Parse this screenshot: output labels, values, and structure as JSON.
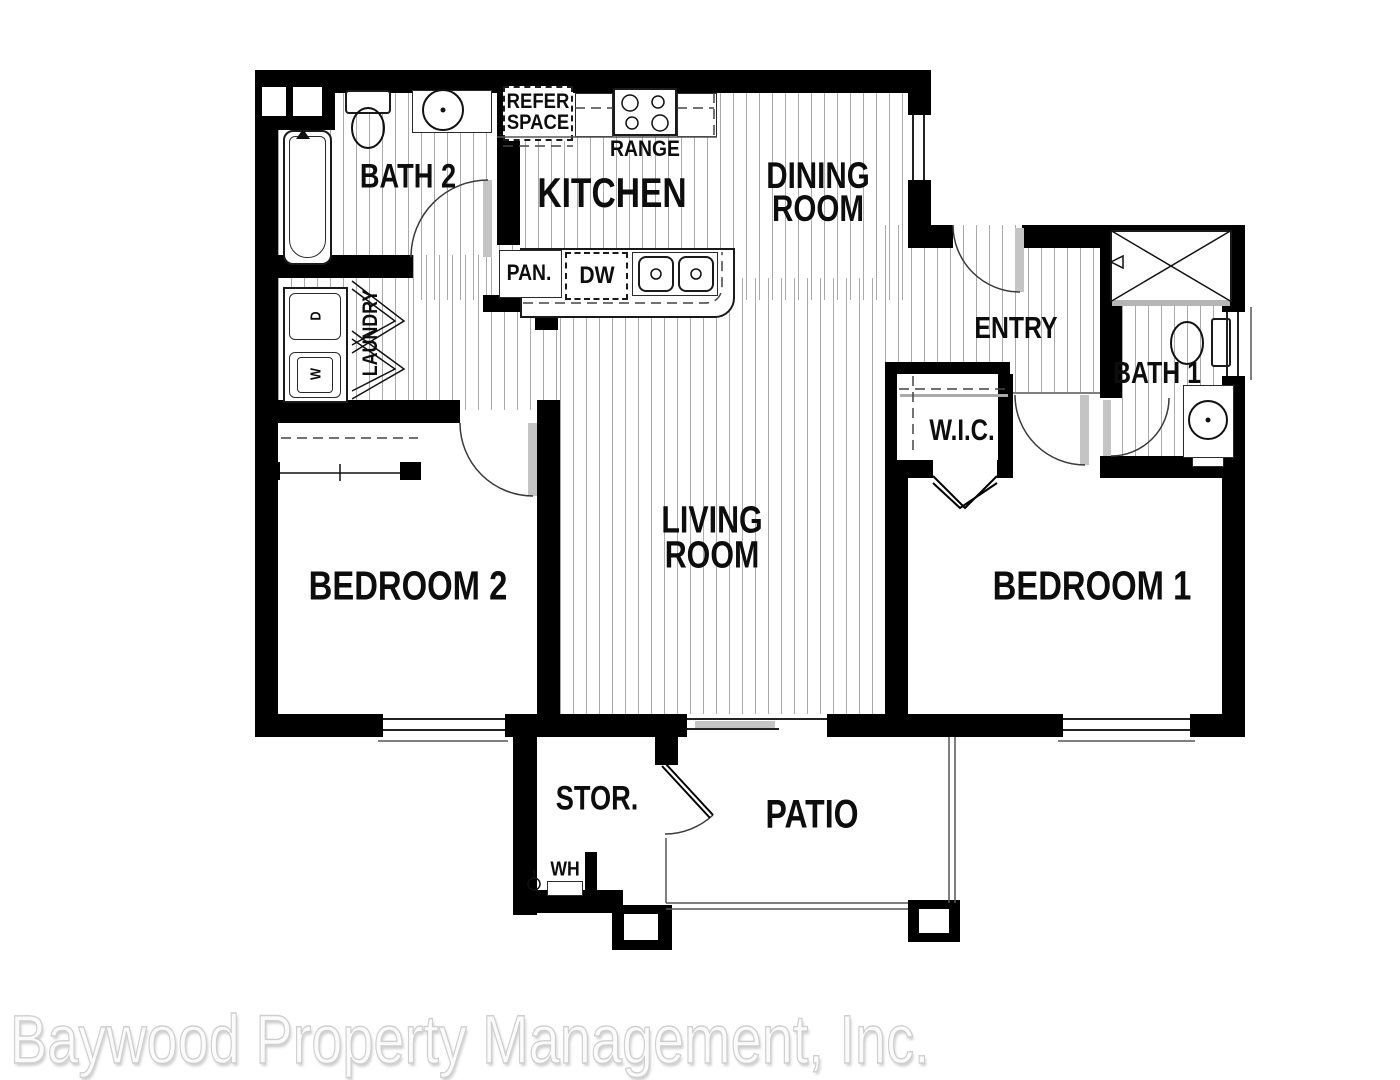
{
  "rooms": {
    "bath2": "BATH 2",
    "kitchen": "KITCHEN",
    "dining1": "DINING",
    "dining2": "ROOM",
    "entry": "ENTRY",
    "bath1": "BATH 1",
    "wic": "W.I.C.",
    "laundry": "LAUNDRY",
    "bedroom2": "BEDROOM 2",
    "living1": "LIVING",
    "living2": "ROOM",
    "bedroom1": "BEDROOM 1",
    "storage": "STOR.",
    "patio": "PATIO"
  },
  "fixtures": {
    "refer1": "REFER",
    "refer2": "SPACE",
    "range": "RANGE",
    "pantry": "PAN.",
    "dishwasher": "DW",
    "water_heater": "WH",
    "dryer": "D",
    "washer": "W"
  },
  "watermark": "Baywood Property Management, Inc.",
  "colors": {
    "wall": "#000000",
    "hatch_line": "#ababab",
    "door_leaf": "#c4c4c4",
    "watermark_text": "#fbfbfb"
  }
}
